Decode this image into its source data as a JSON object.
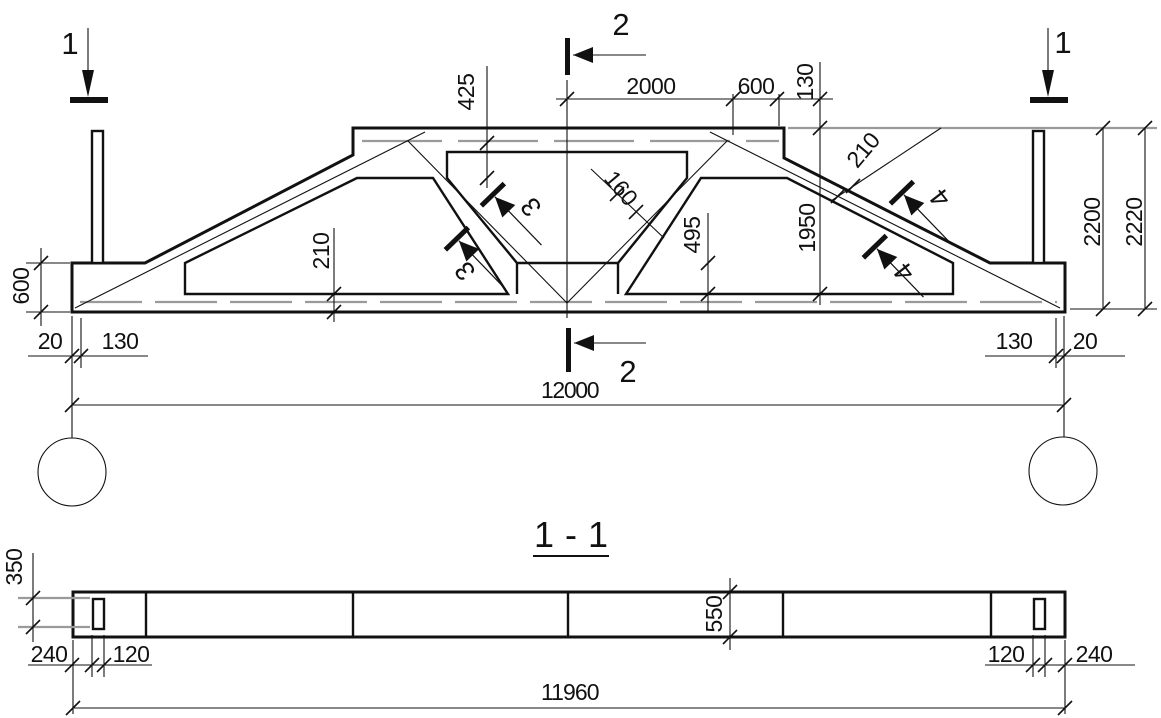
{
  "elevation": {
    "markers": {
      "cut_left": "1",
      "cut_right": "1",
      "cut_top": "2",
      "cut_bottom": "2",
      "detail_upper_left": "3",
      "detail_lower_left": "3",
      "detail_upper_right": "4",
      "detail_lower_right": "4"
    },
    "dims": {
      "top_half_span": "2000",
      "top_haunch": "600",
      "top_edge": "130",
      "haunch_depth": "425",
      "web_thickness": "160",
      "mid_height": "1950",
      "web_offset": "495",
      "slope_thickness": "210",
      "bottom_chord_thickness": "210",
      "end_block_height": "600",
      "left_gap": "20",
      "left_edge": "130",
      "right_edge": "130",
      "right_gap": "20",
      "total_length": "12000",
      "height_inner": "2200",
      "height_overall": "2220"
    }
  },
  "section": {
    "title": "1 - 1",
    "dims": {
      "hole_height": "350",
      "beam_depth": "550",
      "left_end": "240",
      "left_hole": "120",
      "right_hole": "120",
      "right_end": "240",
      "length": "11960"
    }
  }
}
